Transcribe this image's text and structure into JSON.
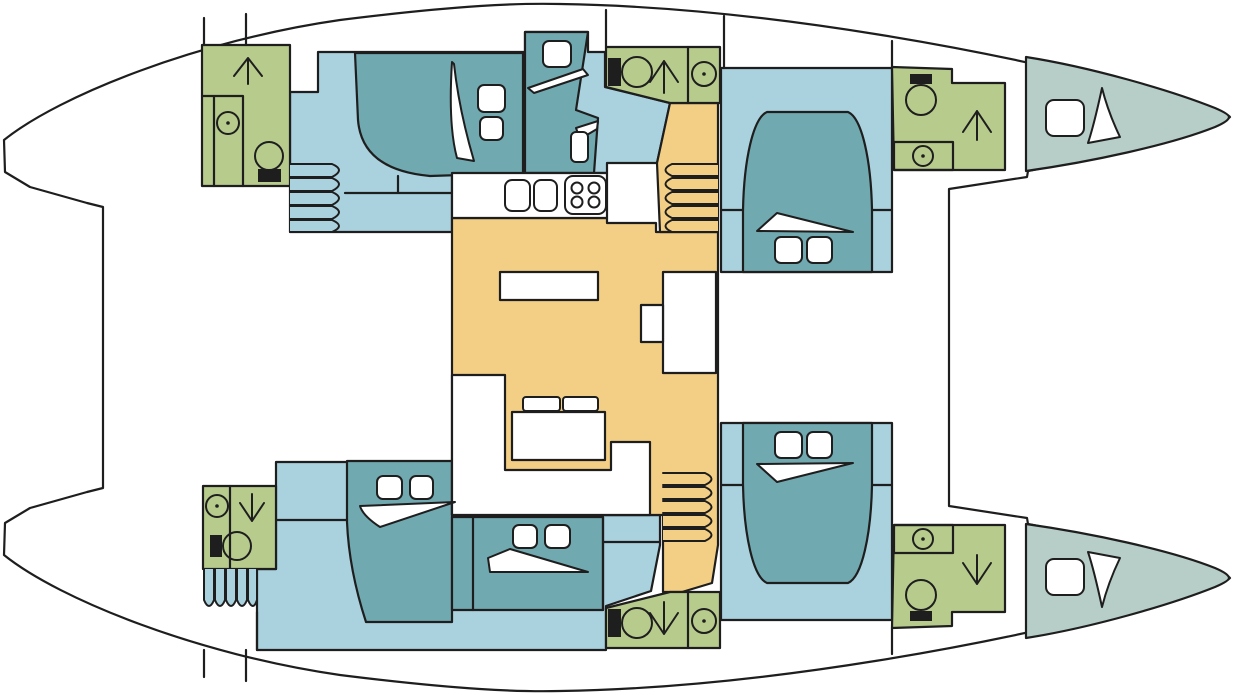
{
  "title": "Catamaran yacht interior deck plan (top view, bows to the right)",
  "colors": {
    "outline": "#1e1e1e",
    "hull_white": "#ffffff",
    "cabin_floor": "#a9d1de",
    "bed_teal": "#71a9b1",
    "bathroom_green": "#b7cb8d",
    "saloon_orange": "#f3cf85",
    "bow_gray": "#b6cdc8"
  },
  "icons": {
    "toilet": "bowl circle with solid black cistern",
    "sink": "circle with center dot",
    "shower": "arrow glyph (up = forward bathrooms top hull, down = bottom hull)",
    "stove": "rounded square with 4 burner circles",
    "hatch": "white rounded square",
    "duvet_fold": "thin white sail-shaped sliver on each bed",
    "pillow": "small white rounded rectangle",
    "steps": "parallel rounded bars"
  },
  "areas": [
    {
      "id": "saloon-galley",
      "color_key": "saloon_orange",
      "features": [
        "galley counter",
        "twin sinks",
        "four-burner stove",
        "coffee table",
        "cabinet unit",
        "U-shaped settee",
        "dining table",
        "two stools"
      ]
    },
    {
      "id": "port-hull-top",
      "color_key": "cabin_floor",
      "features": [
        "aft bathroom with shower, sink, toilet",
        "double bed with 2 pillows",
        "mid single bed with pillow",
        "access steps",
        "companionway steps to saloon"
      ]
    },
    {
      "id": "mid-top-bathroom",
      "color_key": "bathroom_green",
      "features": [
        "toilet",
        "shower (arrow up)",
        "sink"
      ]
    },
    {
      "id": "starboard-hull-top-cabin",
      "color_key": "cabin_floor",
      "features": [
        "island double bed with 2 pillows",
        "forward bathroom with toilet, shower (arrow up), sink"
      ]
    },
    {
      "id": "port-hull-bottom",
      "color_key": "cabin_floor",
      "features": [
        "aft bathroom with sink, shower (arrow down), toilet",
        "double bed with 2 pillows",
        "boarding steps",
        "mid double bed with 2 pillows"
      ]
    },
    {
      "id": "mid-bottom-bathroom",
      "color_key": "bathroom_green",
      "features": [
        "toilet",
        "shower (arrow down)",
        "sink"
      ]
    },
    {
      "id": "starboard-hull-bottom-cabin",
      "color_key": "cabin_floor",
      "features": [
        "island double bed with 2 pillows",
        "forward bathroom with sink, shower (arrow down), toilet"
      ]
    },
    {
      "id": "bow-peaks",
      "color_key": "bow_gray",
      "features": [
        "top bow locker with hatch",
        "bottom bow locker with hatch"
      ]
    }
  ]
}
